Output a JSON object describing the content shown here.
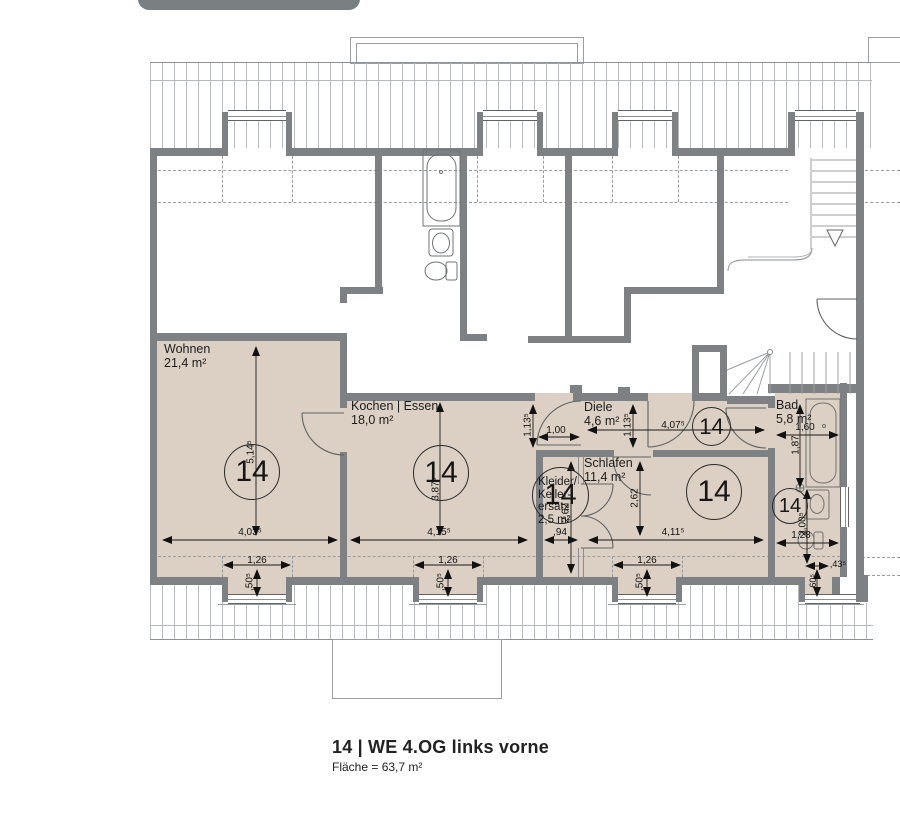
{
  "plan": {
    "unit_number": "14",
    "rooms": [
      {
        "name": "Wohnen",
        "area": "21,4 m²"
      },
      {
        "name": "Kochen | Essen",
        "area": "18,0 m²"
      },
      {
        "name": "Diele",
        "area": "4,6 m²"
      },
      {
        "name": "Schlafen",
        "area": "11,4 m²"
      },
      {
        "name_lines": [
          "Kleider/",
          "Keller-",
          "ersatz"
        ],
        "area": "2,5 m²"
      },
      {
        "name": "Bad",
        "area": "5,8 m²"
      }
    ],
    "dims": {
      "wohnen_width": "4,03⁵",
      "wohnen_depth": "5,14⁵",
      "kochen_width": "4,15⁵",
      "kochen_depth": "3,87⁵",
      "diele_width": "4,07⁵",
      "diele_door_width": "1,00",
      "diele_depth_left": "1,13⁵",
      "diele_depth_right": "1,13⁵",
      "schlafen_width": "4,11⁵",
      "schlafen_depth": "2,62",
      "kleider_width": ",94",
      "kleider_depth": "2,62",
      "bad_width": "1,60",
      "bad_tub_length": "1,87",
      "bad_depth": "2,00⁵",
      "bad_lower_width": "1,28",
      "bad_niche_width": ",43⁵",
      "bad_niche_depth": ",60⁵",
      "dormer_width": "1,26",
      "dormer_depth": ",50⁵"
    },
    "colors": {
      "room_fill": "#dbd0c3",
      "wall": "#7d8183"
    },
    "footer": {
      "title": "14 | WE 4.OG links vorne",
      "area_line": "Fläche = 63,7 m²"
    }
  }
}
